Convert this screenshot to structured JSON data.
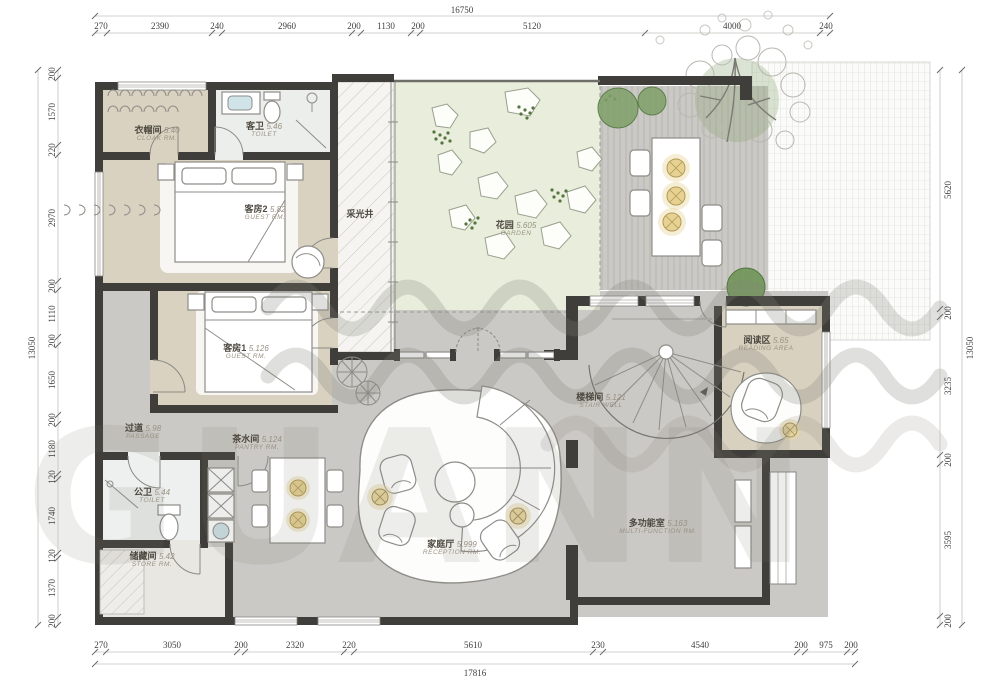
{
  "watermark": {
    "text": "GUANN"
  },
  "dimensions": {
    "top": {
      "total": "16750",
      "segments": [
        "270",
        "2390",
        "240",
        "2960",
        "200",
        "1130",
        "200",
        "5120",
        "4000",
        "240"
      ]
    },
    "bottom": {
      "total": "17816",
      "segments": [
        "270",
        "3050",
        "200",
        "2320",
        "220",
        "5610",
        "230",
        "4540",
        "200",
        "975",
        "200"
      ]
    },
    "left": {
      "total": "13050",
      "segments": [
        "200",
        "1570",
        "220",
        "2970",
        "200",
        "1110",
        "200",
        "1650",
        "200",
        "1180",
        "120",
        "1740",
        "120",
        "1370",
        "200"
      ]
    },
    "right": {
      "total": "13050",
      "segments": [
        "5620",
        "200",
        "3235",
        "200",
        "3595",
        "200"
      ]
    }
  },
  "rooms": [
    {
      "name_cn": "衣帽间",
      "code": "5.40",
      "name_en": "CLOAK RM."
    },
    {
      "name_cn": "客卫",
      "code": "5.46",
      "name_en": "TOILET"
    },
    {
      "name_cn": "客房2",
      "code": "5.82",
      "name_en": "GUEST RM."
    },
    {
      "name_cn": "客房1",
      "code": "5.126",
      "name_en": "GUEST RM."
    },
    {
      "name_cn": "采光井",
      "code": "",
      "name_en": ""
    },
    {
      "name_cn": "花园",
      "code": "5.605",
      "name_en": "GARDEN"
    },
    {
      "name_cn": "阅读区",
      "code": "5.65",
      "name_en": "READING AREA"
    },
    {
      "name_cn": "楼梯间",
      "code": "5.121",
      "name_en": "STAIR WELL"
    },
    {
      "name_cn": "过道",
      "code": "5.98",
      "name_en": "PASSAGE"
    },
    {
      "name_cn": "茶水间",
      "code": "5.124",
      "name_en": "PANTRY RM."
    },
    {
      "name_cn": "公卫",
      "code": "5.44",
      "name_en": "TOILET"
    },
    {
      "name_cn": "储藏间",
      "code": "5.42",
      "name_en": "STORE RM."
    },
    {
      "name_cn": "家庭厅",
      "code": "5.999",
      "name_en": "RECEPTION RM."
    },
    {
      "name_cn": "多功能室",
      "code": "5.163",
      "name_en": "MULTI-FUNCTION RM."
    }
  ],
  "colors": {
    "wall": "#403e3a",
    "room_beige": "#d9d2c1",
    "room_gray": "#cbc9c5",
    "garden_green": "#e8eedb",
    "lamp_yellow": "#e9d8a0",
    "tree_green": "#7fa068"
  }
}
